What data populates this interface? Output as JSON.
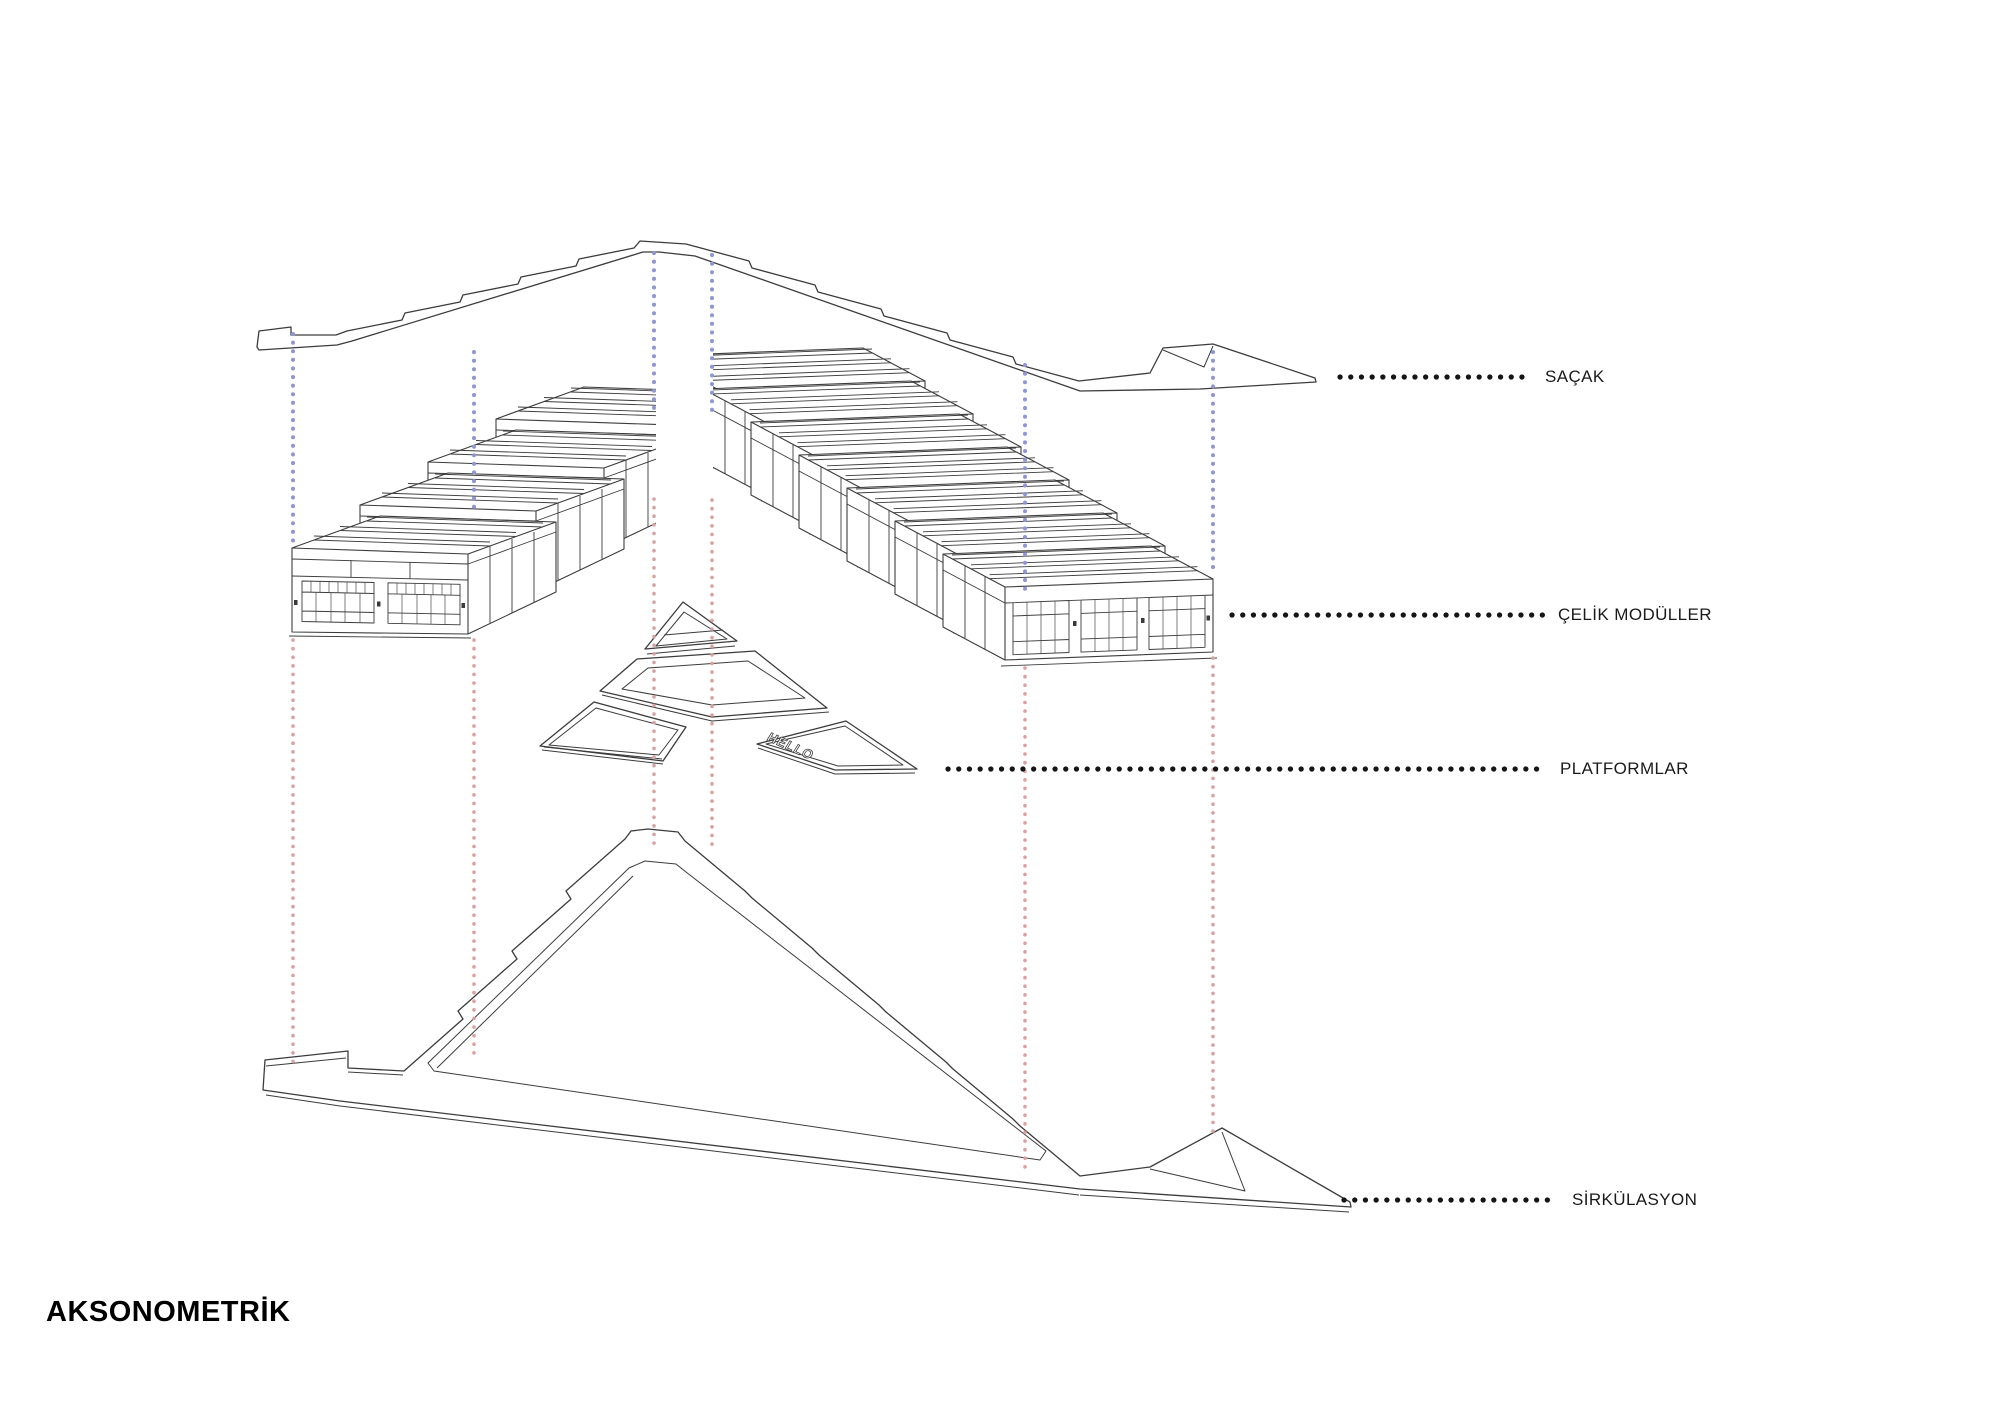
{
  "title": {
    "label": "AKSONOMETRİK"
  },
  "legend": {
    "items": [
      {
        "id": "sacak",
        "label": "SAÇAK"
      },
      {
        "id": "celik",
        "label": "ÇELİK MODÜLLER"
      },
      {
        "id": "platformlar",
        "label": "PLATFORMLAR"
      },
      {
        "id": "sirkulasyon",
        "label": "SİRKÜLASYON"
      }
    ]
  },
  "drawing": {
    "platform_text": "HELLO",
    "layers": {
      "canopy": "SAÇAK",
      "modules": "ÇELİK MODÜLLER",
      "platforms": "PLATFORMLAR",
      "circulation": "SİRKÜLASYON"
    },
    "module_counts": {
      "left_row": 4,
      "right_row": 7
    },
    "colors": {
      "line": "#3c3c3c",
      "guide_blue": "#8f96d2",
      "guide_red": "#d9a2a2",
      "leader_black": "#151515",
      "text": "#1a1a1a"
    }
  }
}
